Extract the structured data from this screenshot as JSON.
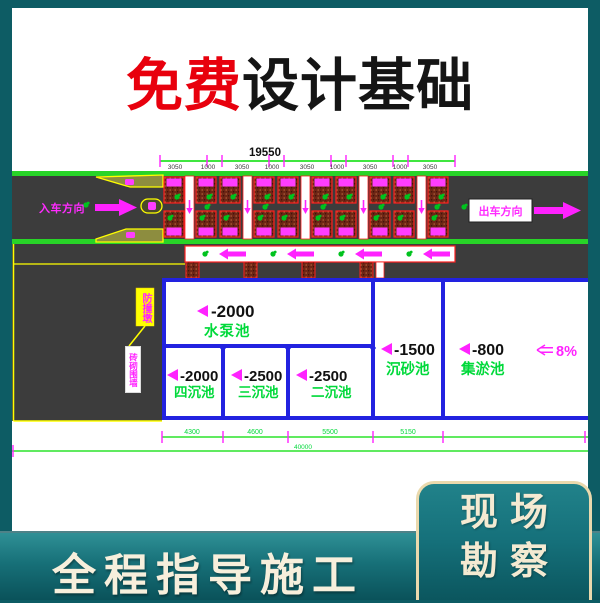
{
  "title": {
    "highlight": "免费",
    "rest": "设计基础"
  },
  "diagram": {
    "total_width": "19550",
    "segments": [
      "3050",
      "1000",
      "3050",
      "1000",
      "3050",
      "1000",
      "3050",
      "1000",
      "3050"
    ],
    "entry_label": "入车方向",
    "exit_label": "出车方向",
    "callouts": {
      "box": "防撞墩",
      "wall": "砖砌围墙"
    },
    "pools": [
      {
        "level": "-2000",
        "name": "水泵池"
      },
      {
        "level": "-2000",
        "name": "四沉池"
      },
      {
        "level": "-2500",
        "name": "三沉池"
      },
      {
        "level": "-2500",
        "name": "二沉池"
      },
      {
        "level": "-1500",
        "name": "沉砂池"
      },
      {
        "level": "-800",
        "name": "集淤池"
      }
    ],
    "slope_label": "8%",
    "bottom_segments": [
      "4300",
      "4600",
      "5500",
      "5150"
    ],
    "site_total": "40000"
  },
  "footer": {
    "band_text": "全程指导施工",
    "panel_line1": "现场",
    "panel_line2": "勘察"
  },
  "colors": {
    "background_teal": "#0d5c64",
    "title_red": "#e8000d",
    "cad_green": "#00d93a",
    "cad_magenta": "#ff22ff",
    "pool_blue": "#2222e0",
    "road_gray": "#3c3c3c",
    "cream_text": "#f7efdc"
  }
}
